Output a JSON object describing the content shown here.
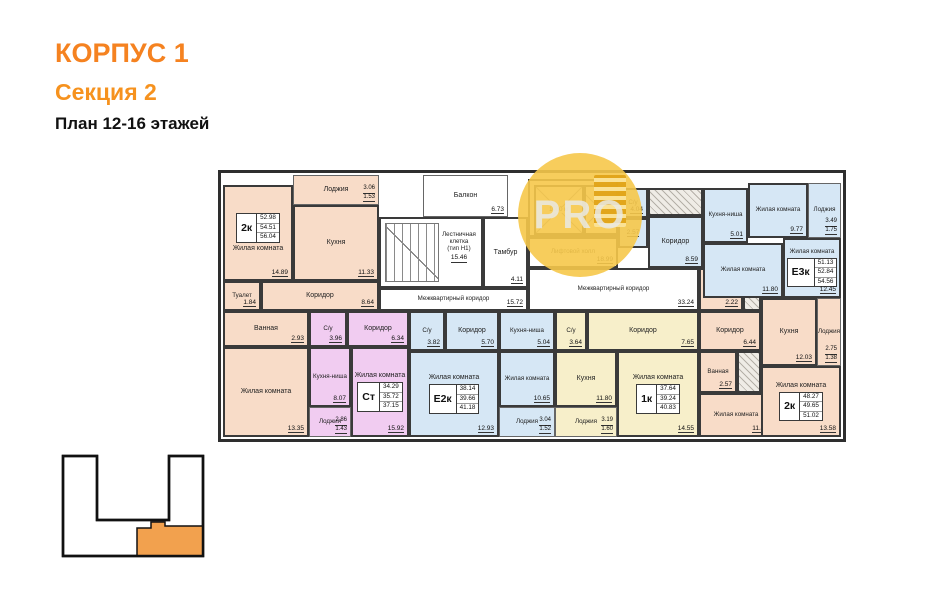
{
  "header": {
    "building": "КОРПУС 1",
    "section": "Секция 2",
    "plan": "План 12-16 этажей"
  },
  "watermark": {
    "text": "PRO"
  },
  "colors": {
    "accent_orange": "#F58220",
    "apartment_pink": "#F8DCC8",
    "apartment_purple": "#F1CCF1",
    "apartment_blue": "#D6E7F5",
    "apartment_yellow": "#F7EFCA",
    "minimap_highlight": "#F2A14E",
    "watermark_yellow": "#F6C84A",
    "wall": "#3A3A3A"
  },
  "common": {
    "balcony": {
      "name": "Балкон",
      "area": "6.73"
    },
    "stairs": {
      "name": "Лестничная клетка",
      "name2": "(тип Н1)",
      "area": "15.46"
    },
    "tambour": {
      "name": "Тамбур",
      "area": "4.11"
    },
    "lift_hall": {
      "name": "Лифтовой холл",
      "area": "18.99"
    },
    "elevator": {
      "capacity": "1000 кг"
    },
    "corridor_left": {
      "name": "Межквартирный коридор",
      "area": "15.72"
    },
    "corridor_right": {
      "name": "Межквартирный коридор",
      "area": "33.24"
    }
  },
  "apartments": [
    {
      "type": "2к",
      "areas": [
        "52.98",
        "54.51",
        "56.04"
      ],
      "rooms": [
        {
          "name": "Лоджия",
          "area": "3.06",
          "area_k": "1.53"
        },
        {
          "name": "Жилая комната",
          "area": "14.89"
        },
        {
          "name": "Кухня",
          "area": "11.33"
        },
        {
          "name": "Туалет",
          "area": "1.84"
        },
        {
          "name": "Ванная",
          "area": "2.93"
        },
        {
          "name": "Коридор",
          "area": "8.64"
        },
        {
          "name": "Жилая комната",
          "area": "13.35"
        }
      ]
    },
    {
      "type": "Ст",
      "areas": [
        "34.29",
        "35.72",
        "37.15"
      ],
      "rooms": [
        {
          "name": "Коридор",
          "area": "6.34"
        },
        {
          "name": "С/у",
          "area": "3.96"
        },
        {
          "name": "Кухня-ниша",
          "area": "8.07"
        },
        {
          "name": "Лоджия",
          "area": "2.86",
          "area_k": "1.43"
        },
        {
          "name": "Жилая комната",
          "area": "15.92"
        }
      ]
    },
    {
      "type": "Е2к",
      "areas": [
        "38.14",
        "39.66",
        "41.18"
      ],
      "rooms": [
        {
          "name": "С/у",
          "area": "3.82"
        },
        {
          "name": "Коридор",
          "area": "5.70"
        },
        {
          "name": "Кухня-ниша",
          "area": "5.04"
        },
        {
          "name": "Жилая комната",
          "area": "12.93"
        },
        {
          "name": "Жилая комната",
          "area": "10.65"
        },
        {
          "name": "Лоджия",
          "area": "3.04",
          "area_k": "1.52"
        }
      ]
    },
    {
      "type": "1к",
      "areas": [
        "37.64",
        "39.24",
        "40.83"
      ],
      "rooms": [
        {
          "name": "С/у",
          "area": "3.64"
        },
        {
          "name": "Коридор",
          "area": "7.65"
        },
        {
          "name": "Кухня",
          "area": "11.80"
        },
        {
          "name": "Жилая комната",
          "area": "14.55"
        },
        {
          "name": "Лоджия",
          "area": "3.19",
          "area_k": "1.60"
        }
      ]
    },
    {
      "type": "2к",
      "areas": [
        "48.27",
        "49.65",
        "51.02"
      ],
      "rooms": [
        {
          "name": "Туалет",
          "area": "2.22"
        },
        {
          "name": "Коридор",
          "area": "6.44"
        },
        {
          "name": "Ванная",
          "area": "2.57"
        },
        {
          "name": "Кухня",
          "area": "12.03"
        },
        {
          "name": "Жилая комната",
          "area": "11.43"
        },
        {
          "name": "Жилая комната",
          "area": "13.58"
        },
        {
          "name": "Лоджия",
          "area": "2.75",
          "area_k": "1.38"
        }
      ]
    },
    {
      "type": "Е3к",
      "areas": [
        "51.13",
        "52.84",
        "54.56"
      ],
      "rooms": [
        {
          "name": "С/у",
          "area": "4.04"
        },
        {
          "name": "",
          "area": "2.57"
        },
        {
          "name": "Коридор",
          "area": "8.59"
        },
        {
          "name": "Кухня-ниша",
          "area": "5.01"
        },
        {
          "name": "Жилая комната",
          "area": "9.77"
        },
        {
          "name": "Лоджия",
          "area": "3.49",
          "area_k": "1.75"
        },
        {
          "name": "Жилая комната",
          "area": "11.80"
        },
        {
          "name": "Жилая комната",
          "area": "12.45"
        }
      ]
    }
  ]
}
